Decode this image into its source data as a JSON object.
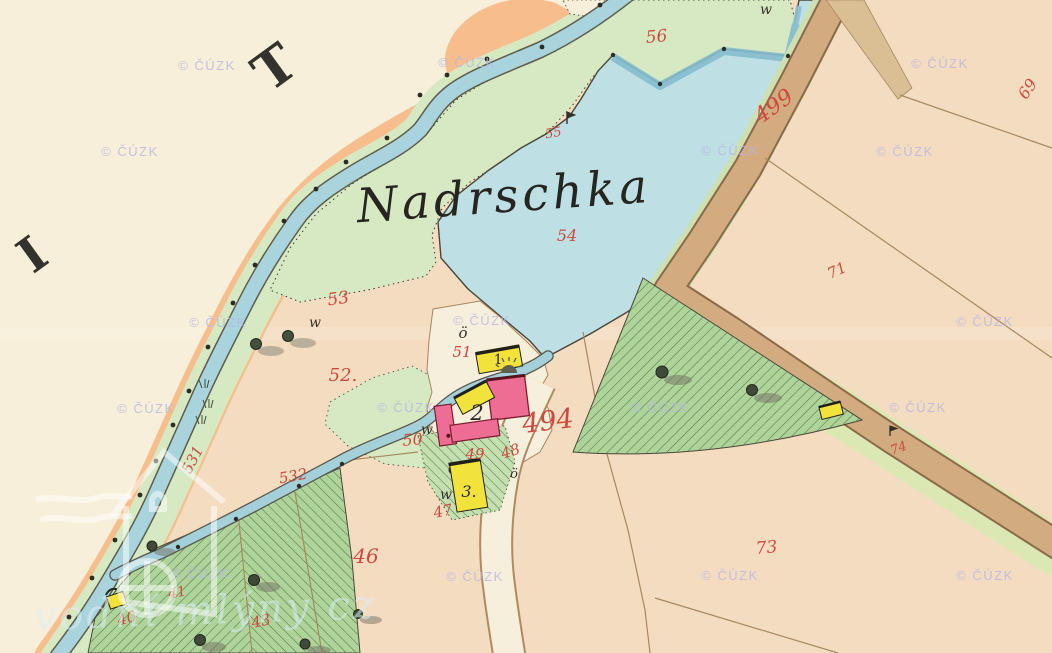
{
  "map": {
    "kind": "historical cadastral map sheet",
    "pond_name": "Nadrschka",
    "sheet_letters": [
      {
        "char": "I"
      },
      {
        "char": "T"
      }
    ],
    "parcel_numbers": [
      {
        "n": "40"
      },
      {
        "n": "41"
      },
      {
        "n": "43"
      },
      {
        "n": "46"
      },
      {
        "n": "47"
      },
      {
        "n": "48"
      },
      {
        "n": "49"
      },
      {
        "n": "50"
      },
      {
        "n": "51"
      },
      {
        "n": "52."
      },
      {
        "n": "53"
      },
      {
        "n": "54"
      },
      {
        "n": "55"
      },
      {
        "n": "56"
      },
      {
        "n": "69"
      },
      {
        "n": "71"
      },
      {
        "n": "73"
      },
      {
        "n": "74"
      },
      {
        "n": "494"
      },
      {
        "n": "499"
      },
      {
        "n": "531"
      },
      {
        "n": "532"
      }
    ],
    "house_numbers": [
      {
        "n": "1"
      },
      {
        "n": "2"
      },
      {
        "n": "3."
      }
    ],
    "landuse_marks": {
      "meadow": "w",
      "other": "ö"
    },
    "colors": {
      "paper": "#f7efd9",
      "field": "#f4dcc0",
      "shore_orange": "#f7bd8d",
      "stream_blue": "#a9d4de",
      "pond_blue": "#bedfe4",
      "meadow_green": "#d6e9c3",
      "woodland_green": "#aed49a",
      "road_tan": "#d2ab80",
      "parcel_number_red": "#ce4a41",
      "building_pink": "#ee6d95",
      "building_yellow": "#f2e23c",
      "watermark_lavender": "#b7b6e3"
    }
  },
  "watermarks": {
    "cuzk": "© ČÚZK",
    "brand": "vodní mlýny cz"
  }
}
